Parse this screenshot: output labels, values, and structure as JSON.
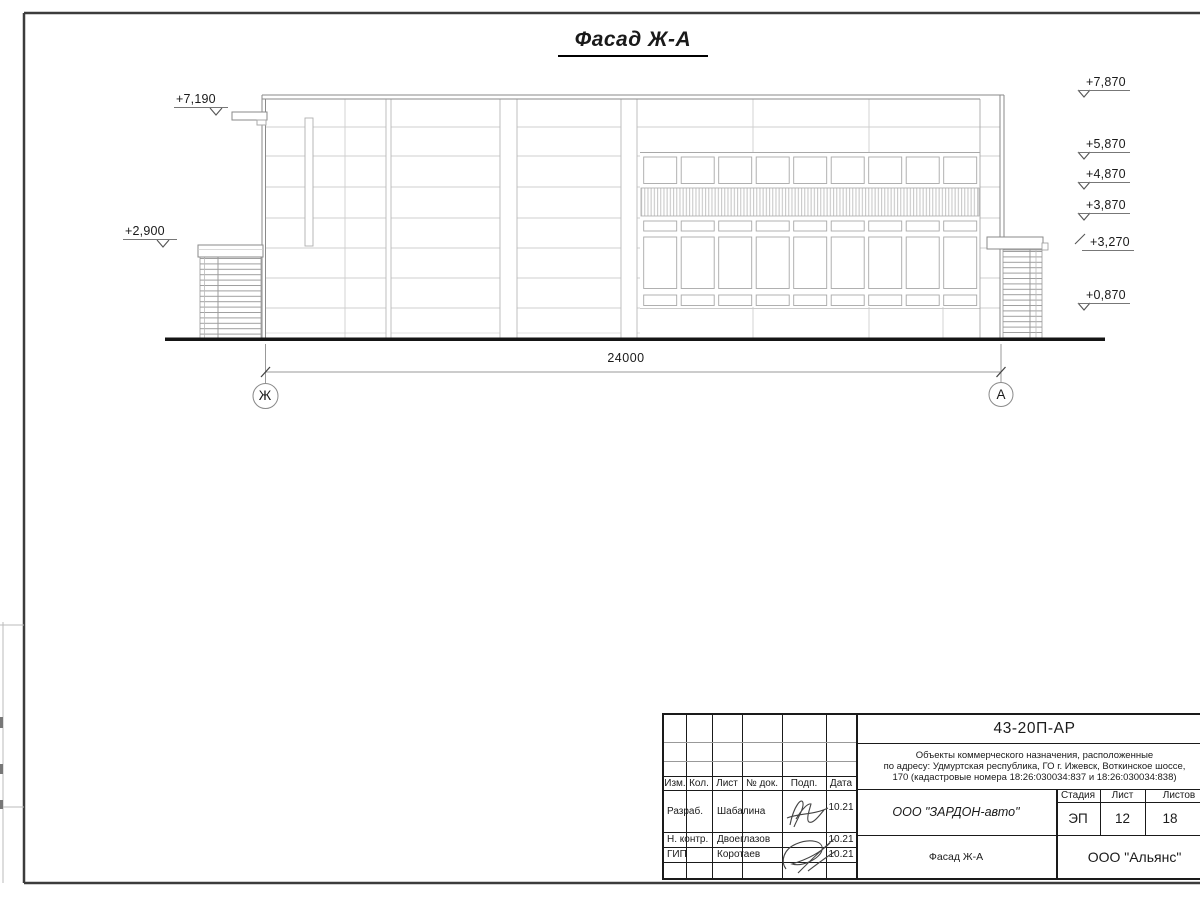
{
  "drawing": {
    "title": "Фасад Ж-А",
    "dimension": "24000",
    "axes": {
      "left": "Ж",
      "right": "А"
    },
    "marks_left": [
      {
        "label": "+7,190"
      },
      {
        "label": "+2,900"
      }
    ],
    "marks_right": [
      {
        "label": "+7,870"
      },
      {
        "label": "+5,870"
      },
      {
        "label": "+4,870"
      },
      {
        "label": "+3,870"
      },
      {
        "label": "+3,270"
      },
      {
        "label": "+0,870"
      }
    ]
  },
  "title_block": {
    "doc_number": "43-20П-АР",
    "description_line1": "Объекты коммерческого назначения, расположенные",
    "description_line2": "по адресу: Удмуртская республика, ГО г. Ижевск, Воткинское шоссе,",
    "description_line3": "170 (кадастровые номера 18:26:030034:837 и 18:26:030034:838)",
    "columns": {
      "izm": "Изм.",
      "kol": "Кол.",
      "list": "Лист",
      "doc": "№ док.",
      "podp": "Подп.",
      "data": "Дата"
    },
    "rows": [
      {
        "role": "Разраб.",
        "name": "Шабалина",
        "date": "10.21"
      },
      {
        "role": "Н. контр.",
        "name": "Двоеглазов",
        "date": "10.21"
      },
      {
        "role": "ГИП",
        "name": "Коротаев",
        "date": "10.21"
      }
    ],
    "client": "ООО \"ЗАРДОН-авто\"",
    "stage_header": {
      "stage": "Стадия",
      "sheet": "Лист",
      "sheets": "Листов"
    },
    "stage_values": {
      "stage": "ЭП",
      "sheet": "12",
      "sheets": "18"
    },
    "drawing_name": "Фасад Ж-А",
    "company": "ООО \"Альянс\"",
    "colors": {
      "line": "#1a1a1a"
    }
  }
}
